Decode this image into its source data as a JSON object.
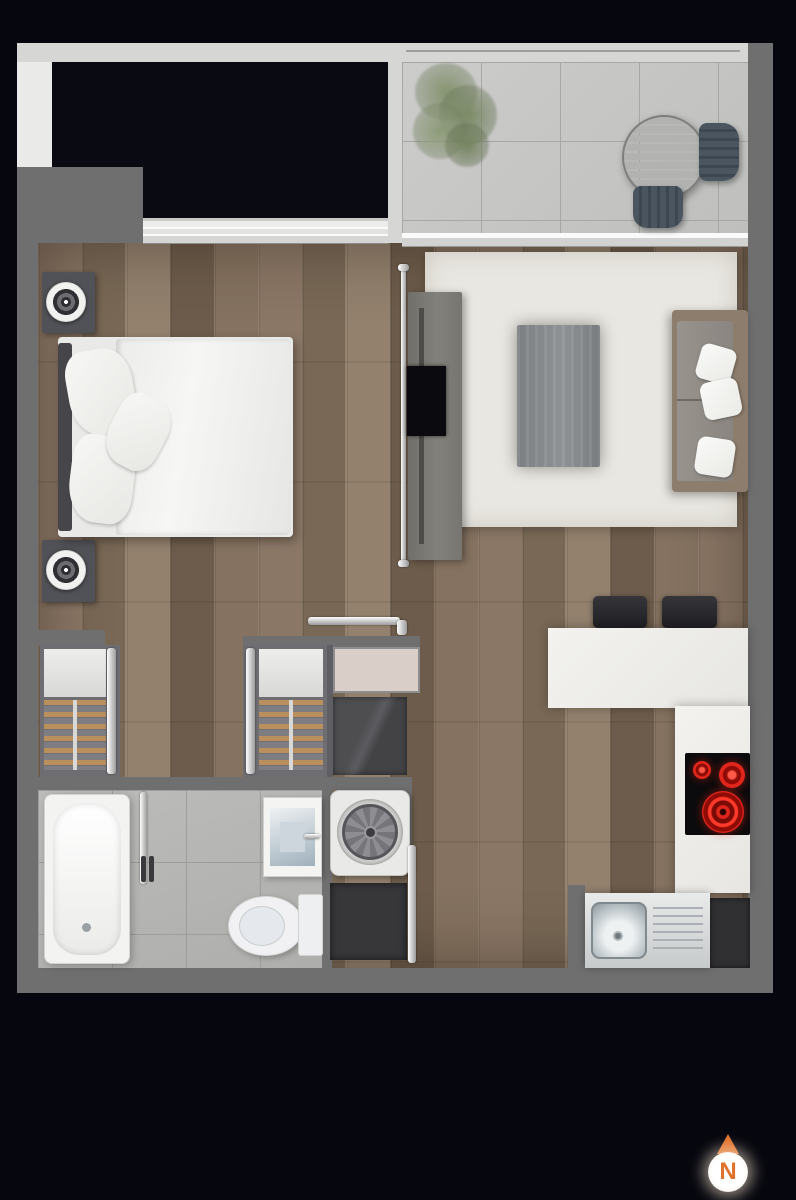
{
  "image": {
    "type": "floor-plan",
    "description": "Top-down rendered floor plan of a one-bedroom apartment with balcony"
  },
  "compass": {
    "label": "N",
    "arrow_color": "#e0712c",
    "disc_color": "#ffffff"
  },
  "palette": {
    "background": "#06060e",
    "exterior_wall_light": "#d6d6d4",
    "interior_wall_gray": "#6f6f70",
    "wood_floor": "#82705f",
    "balcony_tile": "#c6c6c4",
    "bathroom_tile": "#b5b5b3",
    "rug": "#e9e7e1",
    "counter_white": "#f0efec",
    "cooktop_burner_red": "#e2261c",
    "hanger_tan": "#b98f5e",
    "compass_orange": "#e0712c"
  },
  "rooms": [
    {
      "id": "balcony",
      "furniture": [
        "plant",
        "round-table",
        "chair",
        "chair"
      ]
    },
    {
      "id": "bedroom",
      "furniture": [
        "double-bed",
        "nightstand-with-lamp",
        "nightstand-with-lamp",
        "window-band"
      ]
    },
    {
      "id": "living-room",
      "furniture": [
        "area-rug",
        "coffee-table",
        "sofa-with-pillows",
        "tv-unit",
        "tv"
      ]
    },
    {
      "id": "hallway",
      "furniture": [
        "wardrobe",
        "wardrobe",
        "sliding-door"
      ]
    },
    {
      "id": "laundry",
      "furniture": [
        "cabinet",
        "dark-appliance",
        "washing-machine",
        "dark-cabinet"
      ]
    },
    {
      "id": "bathroom",
      "furniture": [
        "bathtub",
        "washbasin",
        "toilet",
        "sliding-door"
      ]
    },
    {
      "id": "kitchen",
      "furniture": [
        "breakfast-bar",
        "bar-stool",
        "bar-stool",
        "cooktop",
        "kitchen-sink",
        "dishwasher"
      ]
    }
  ]
}
